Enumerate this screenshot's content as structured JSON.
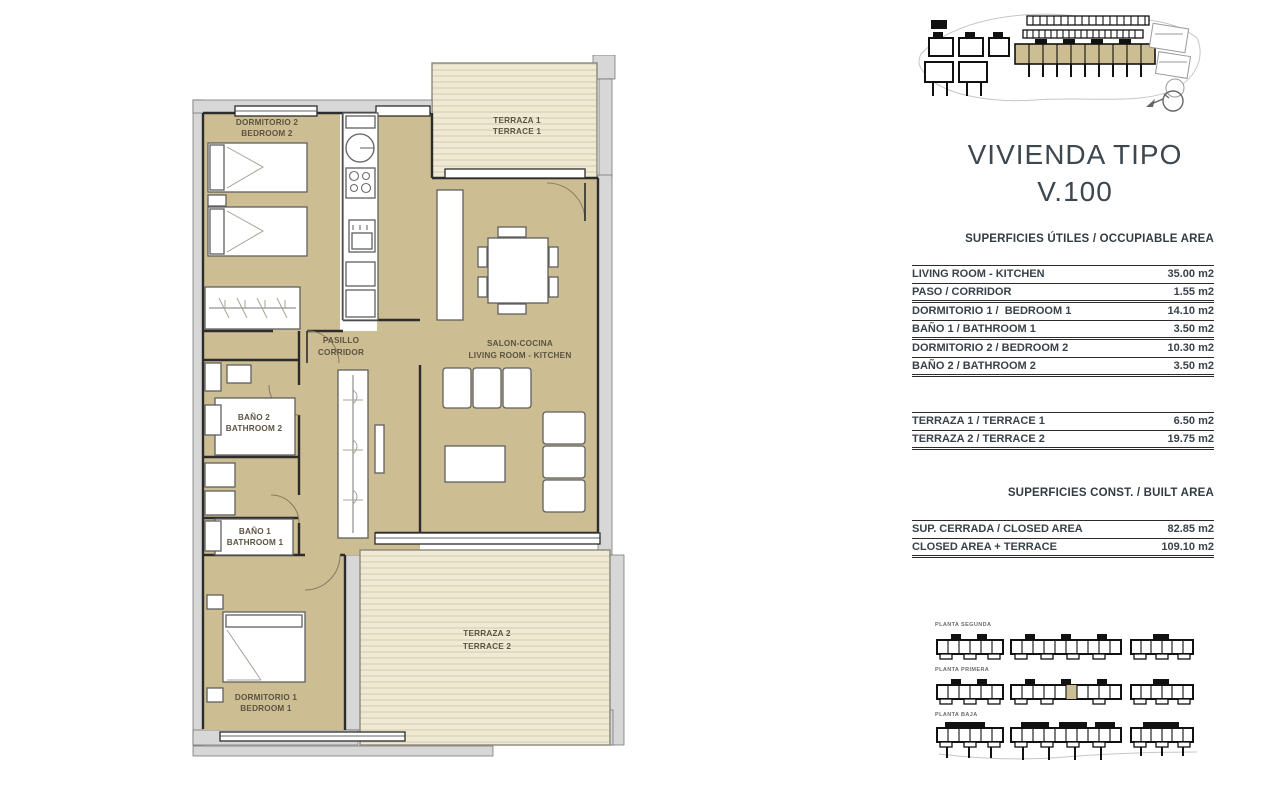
{
  "title": {
    "line1": "VIVIENDA TIPO",
    "line2": "V.100"
  },
  "sections": {
    "occupiable": {
      "header": "SUPERFICIES ÚTILES / OCCUPIABLE AREA",
      "rows": [
        {
          "label": "LIVING ROOM - KITCHEN",
          "value": "35.00 m2"
        },
        {
          "label": "PASO / CORRIDOR",
          "value": "1.55 m2"
        },
        {
          "label": "DORMITORIO 1 /  BEDROOM 1",
          "value": "14.10 m2"
        },
        {
          "label": "BAÑO 1 / BATHROOM 1",
          "value": "3.50 m2"
        },
        {
          "label": "DORMITORIO 2 / BEDROOM 2",
          "value": "10.30 m2"
        },
        {
          "label": "BAÑO 2 / BATHROOM 2",
          "value": "3.50 m2"
        }
      ]
    },
    "terraces": {
      "rows": [
        {
          "label": "TERRAZA 1 / TERRACE 1",
          "value": "6.50 m2"
        },
        {
          "label": "TERRAZA 2 / TERRACE 2",
          "value": "19.75 m2"
        }
      ]
    },
    "built": {
      "header": "SUPERFICIES  CONST. / BUILT AREA",
      "rows": [
        {
          "label": "SUP. CERRADA / CLOSED AREA",
          "value": "82.85 m2"
        },
        {
          "label": "CLOSED AREA + TERRACE",
          "value": "109.10 m2"
        }
      ]
    }
  },
  "plan": {
    "rooms": {
      "bedroom2": {
        "l1": "DORMITORIO 2",
        "l2": "BEDROOM 2"
      },
      "terrace1": {
        "l1": "TERRAZA 1",
        "l2": "TERRACE 1"
      },
      "corridor": {
        "l1": "PASILLO",
        "l2": "CORRIDOR"
      },
      "living": {
        "l1": "SALON-COCINA",
        "l2": "LIVING ROOM - KITCHEN"
      },
      "bath2": {
        "l1": "BAÑO 2",
        "l2": "BATHROOM 2"
      },
      "bath1": {
        "l1": "BAÑO 1",
        "l2": "BATHROOM 1"
      },
      "bedroom1": {
        "l1": "DORMITORIO 1",
        "l2": "BEDROOM 1"
      },
      "terrace2": {
        "l1": "TERRAZA 2",
        "l2": "TERRACE 2"
      }
    }
  },
  "floors": {
    "labels": [
      "PLANTA SEGUNDA",
      "PLANTA PRIMERA",
      "PLANTA BAJA"
    ]
  },
  "colors": {
    "room_fill": "#cdbd92",
    "terrace_fill": "#f0e9d5",
    "terrace_stripe": "#d9d0ae",
    "wall_fill": "#d7d7d7",
    "wall_line": "#2c2c2c",
    "plan_label": "#5c5442",
    "panel_text": "#39424a",
    "table_line": "#2b2b2b",
    "highlight_unit": "#cdbd92"
  }
}
